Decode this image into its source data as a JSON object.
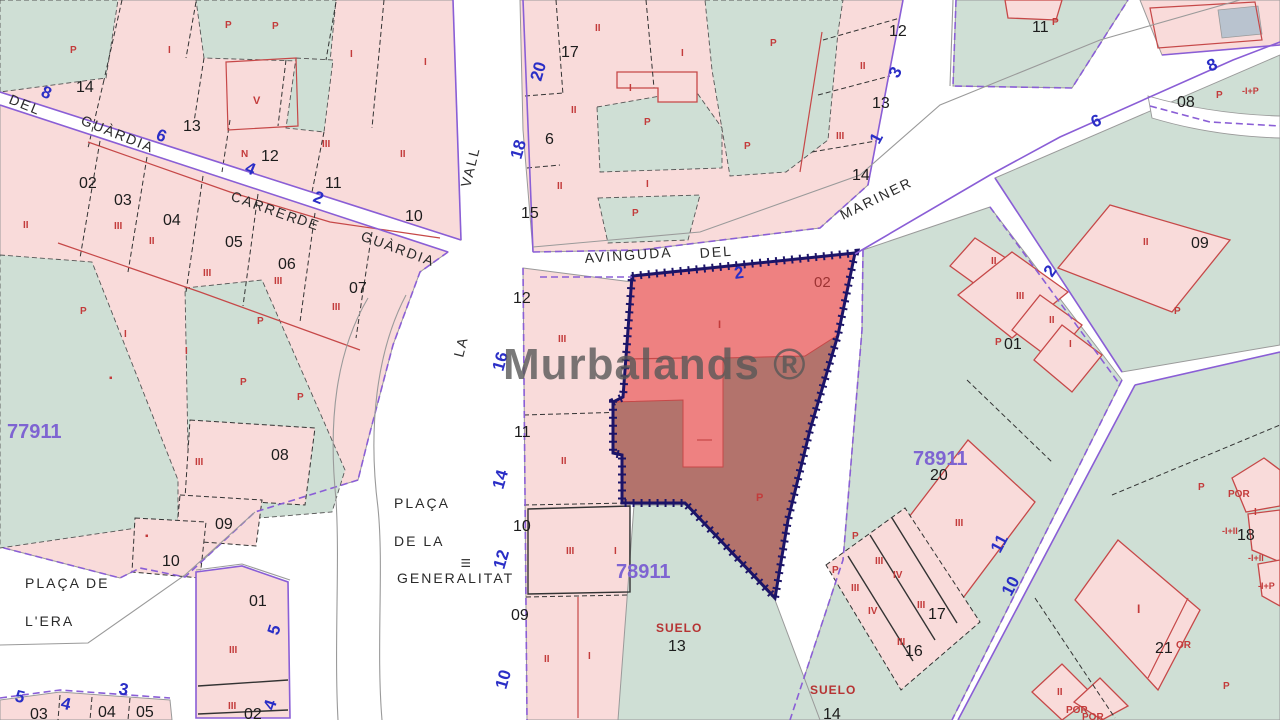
{
  "map": {
    "watermark": "Murbalands ®",
    "colors": {
      "parcel_pink": "#f9dbda",
      "parcel_green": "#cfdfd5",
      "highlight_light": "#ee8181",
      "highlight_dark": "#b3736c",
      "highlight_border": "#1c1468",
      "cadastral_purple": "#8a5ed6",
      "street_number_blue": "#2a2ec6",
      "construction_red": "#c33b3b",
      "zone_purple": "#7e64d2"
    },
    "street_names": [
      {
        "t": "DEL",
        "x": 8,
        "y": 103,
        "r": 22
      },
      {
        "t": "GUÀRDIA",
        "x": 80,
        "y": 124,
        "r": 22
      },
      {
        "t": "CARRER",
        "x": 230,
        "y": 200,
        "r": 20
      },
      {
        "t": "DE",
        "x": 296,
        "y": 223,
        "r": 20
      },
      {
        "t": "GUÀRDIA",
        "x": 360,
        "y": 240,
        "r": 20
      },
      {
        "t": "VALL",
        "x": 470,
        "y": 188,
        "r": -76
      },
      {
        "t": "LA",
        "x": 463,
        "y": 358,
        "r": -76
      },
      {
        "t": "AVINGUDA",
        "x": 585,
        "y": 263,
        "r": -4
      },
      {
        "t": "DEL",
        "x": 700,
        "y": 258,
        "r": -4
      },
      {
        "t": "MARINER",
        "x": 843,
        "y": 220,
        "r": -26
      },
      {
        "t": "PLAÇA",
        "x": 394,
        "y": 508
      },
      {
        "t": "DE LA",
        "x": 394,
        "y": 546
      },
      {
        "t": "GENERALITAT",
        "x": 397,
        "y": 583
      },
      {
        "t": "PLAÇA DE",
        "x": 25,
        "y": 588
      },
      {
        "t": "L'ERA",
        "x": 25,
        "y": 626
      }
    ],
    "parcel_numbers": [
      {
        "t": "14",
        "x": 76,
        "y": 92
      },
      {
        "t": "13",
        "x": 183,
        "y": 131
      },
      {
        "t": "12",
        "x": 261,
        "y": 161
      },
      {
        "t": "11",
        "x": 325,
        "y": 188
      },
      {
        "t": "10",
        "x": 405,
        "y": 221
      },
      {
        "t": "02",
        "x": 79,
        "y": 188
      },
      {
        "t": "03",
        "x": 114,
        "y": 205
      },
      {
        "t": "04",
        "x": 163,
        "y": 225
      },
      {
        "t": "05",
        "x": 225,
        "y": 247
      },
      {
        "t": "06",
        "x": 278,
        "y": 269
      },
      {
        "t": "07",
        "x": 349,
        "y": 293
      },
      {
        "t": "08",
        "x": 271,
        "y": 460
      },
      {
        "t": "09",
        "x": 215,
        "y": 529
      },
      {
        "t": "10",
        "x": 162,
        "y": 566
      },
      {
        "t": "01",
        "x": 249,
        "y": 606
      },
      {
        "t": "02",
        "x": 244,
        "y": 719
      },
      {
        "t": "03",
        "x": 30,
        "y": 719
      },
      {
        "t": "04",
        "x": 98,
        "y": 717
      },
      {
        "t": "05",
        "x": 136,
        "y": 717
      },
      {
        "t": "12",
        "x": 513,
        "y": 303
      },
      {
        "t": "11",
        "x": 514,
        "y": 437
      },
      {
        "t": "10",
        "x": 513,
        "y": 531
      },
      {
        "t": "09",
        "x": 511,
        "y": 620
      },
      {
        "t": "17",
        "x": 561,
        "y": 57
      },
      {
        "t": "6",
        "x": 545,
        "y": 144
      },
      {
        "t": "15",
        "x": 521,
        "y": 218
      },
      {
        "t": "12",
        "x": 889,
        "y": 36
      },
      {
        "t": "13",
        "x": 872,
        "y": 108
      },
      {
        "t": "14",
        "x": 852,
        "y": 180
      },
      {
        "t": "11",
        "x": 1032,
        "y": 32
      },
      {
        "t": "08",
        "x": 1177,
        "y": 107
      },
      {
        "t": "09",
        "x": 1191,
        "y": 248
      },
      {
        "t": "01",
        "x": 1004,
        "y": 349
      },
      {
        "t": "20",
        "x": 930,
        "y": 480
      },
      {
        "t": "17",
        "x": 928,
        "y": 619
      },
      {
        "t": "16",
        "x": 905,
        "y": 656
      },
      {
        "t": "18",
        "x": 1237,
        "y": 540
      },
      {
        "t": "21",
        "x": 1155,
        "y": 653
      },
      {
        "t": "13",
        "x": 668,
        "y": 651
      },
      {
        "t": "14",
        "x": 823,
        "y": 719
      },
      {
        "t": "02",
        "x": 814,
        "y": 287,
        "c": "#9c3333",
        "s": 15
      },
      {
        "t": "III",
        "x": 470,
        "y": 568,
        "r": -90,
        "s": 12
      }
    ],
    "street_numbers": [
      {
        "t": "8",
        "x": 40,
        "y": 96,
        "r": 22
      },
      {
        "t": "6",
        "x": 155,
        "y": 139,
        "r": 22
      },
      {
        "t": "4",
        "x": 244,
        "y": 172,
        "r": 22
      },
      {
        "t": "2",
        "x": 312,
        "y": 201,
        "r": 22
      },
      {
        "t": "20",
        "x": 541,
        "y": 82,
        "r": -74
      },
      {
        "t": "18",
        "x": 521,
        "y": 160,
        "r": -74
      },
      {
        "t": "16",
        "x": 503,
        "y": 372,
        "r": -74
      },
      {
        "t": "14",
        "x": 503,
        "y": 490,
        "r": -74
      },
      {
        "t": "12",
        "x": 504,
        "y": 570,
        "r": -74
      },
      {
        "t": "10",
        "x": 506,
        "y": 690,
        "r": -74
      },
      {
        "t": "2",
        "x": 735,
        "y": 279,
        "r": -8
      },
      {
        "t": "3",
        "x": 898,
        "y": 79,
        "r": -62
      },
      {
        "t": "1",
        "x": 879,
        "y": 145,
        "r": -62
      },
      {
        "t": "6",
        "x": 1094,
        "y": 128,
        "r": -24
      },
      {
        "t": "8",
        "x": 1210,
        "y": 72,
        "r": -24
      },
      {
        "t": "2",
        "x": 1052,
        "y": 278,
        "r": -55
      },
      {
        "t": "11",
        "x": 1000,
        "y": 554,
        "r": -62
      },
      {
        "t": "10",
        "x": 1011,
        "y": 597,
        "r": -62
      },
      {
        "t": "5",
        "x": 278,
        "y": 636,
        "r": -72
      },
      {
        "t": "4",
        "x": 274,
        "y": 711,
        "r": -72
      },
      {
        "t": "5",
        "x": 14,
        "y": 701,
        "r": 14
      },
      {
        "t": "4",
        "x": 60,
        "y": 708,
        "r": 14
      },
      {
        "t": "3",
        "x": 118,
        "y": 694,
        "r": 10
      }
    ],
    "zone_numbers": [
      {
        "t": "77911",
        "x": 7,
        "y": 438
      },
      {
        "t": "78911",
        "x": 616,
        "y": 578
      },
      {
        "t": "78911",
        "x": 913,
        "y": 465
      }
    ],
    "construction_labels": [
      {
        "t": "P",
        "x": 70,
        "y": 53
      },
      {
        "t": "I",
        "x": 168,
        "y": 53
      },
      {
        "t": "P",
        "x": 225,
        "y": 28
      },
      {
        "t": "P",
        "x": 272,
        "y": 29
      },
      {
        "t": "V",
        "x": 253,
        "y": 104,
        "s": 11
      },
      {
        "t": "I",
        "x": 350,
        "y": 57
      },
      {
        "t": "I",
        "x": 424,
        "y": 65
      },
      {
        "t": "III",
        "x": 322,
        "y": 147
      },
      {
        "t": "II",
        "x": 400,
        "y": 157
      },
      {
        "t": "N",
        "x": 241,
        "y": 157
      },
      {
        "t": "II",
        "x": 23,
        "y": 228
      },
      {
        "t": "III",
        "x": 114,
        "y": 229
      },
      {
        "t": "II",
        "x": 149,
        "y": 244
      },
      {
        "t": "III",
        "x": 203,
        "y": 276
      },
      {
        "t": "III",
        "x": 274,
        "y": 284
      },
      {
        "t": "III",
        "x": 332,
        "y": 310
      },
      {
        "t": "P",
        "x": 80,
        "y": 314
      },
      {
        "t": "P",
        "x": 257,
        "y": 324
      },
      {
        "t": "I",
        "x": 124,
        "y": 337
      },
      {
        "t": "I",
        "x": 185,
        "y": 354
      },
      {
        "t": "P",
        "x": 240,
        "y": 385
      },
      {
        "t": "P",
        "x": 297,
        "y": 400
      },
      {
        "t": "▪",
        "x": 109,
        "y": 381
      },
      {
        "t": "III",
        "x": 195,
        "y": 465
      },
      {
        "t": "▪",
        "x": 145,
        "y": 539
      },
      {
        "t": "III",
        "x": 229,
        "y": 653
      },
      {
        "t": "III",
        "x": 228,
        "y": 709
      },
      {
        "t": "III",
        "x": 558,
        "y": 342
      },
      {
        "t": "II",
        "x": 561,
        "y": 464
      },
      {
        "t": "III",
        "x": 566,
        "y": 554
      },
      {
        "t": "I",
        "x": 614,
        "y": 554
      },
      {
        "t": "II",
        "x": 544,
        "y": 662
      },
      {
        "t": "I",
        "x": 588,
        "y": 659
      },
      {
        "t": "I",
        "x": 718,
        "y": 328,
        "s": 11
      },
      {
        "t": "P",
        "x": 756,
        "y": 501,
        "s": 11
      },
      {
        "t": "II",
        "x": 595,
        "y": 31
      },
      {
        "t": "I",
        "x": 681,
        "y": 56
      },
      {
        "t": "P",
        "x": 770,
        "y": 46
      },
      {
        "t": "II",
        "x": 860,
        "y": 69
      },
      {
        "t": "II",
        "x": 571,
        "y": 113
      },
      {
        "t": "I",
        "x": 629,
        "y": 91
      },
      {
        "t": "P",
        "x": 644,
        "y": 125
      },
      {
        "t": "P",
        "x": 744,
        "y": 149
      },
      {
        "t": "II",
        "x": 557,
        "y": 189
      },
      {
        "t": "I",
        "x": 646,
        "y": 187
      },
      {
        "t": "P",
        "x": 632,
        "y": 216
      },
      {
        "t": "III",
        "x": 836,
        "y": 139
      },
      {
        "t": "P",
        "x": 1052,
        "y": 25
      },
      {
        "t": "P",
        "x": 1216,
        "y": 98
      },
      {
        "t": "-I+P",
        "x": 1242,
        "y": 94,
        "s": 9
      },
      {
        "t": "II",
        "x": 1143,
        "y": 245
      },
      {
        "t": "P",
        "x": 1174,
        "y": 314
      },
      {
        "t": "II",
        "x": 991,
        "y": 264
      },
      {
        "t": "III",
        "x": 1016,
        "y": 299
      },
      {
        "t": "II",
        "x": 1049,
        "y": 323
      },
      {
        "t": "I",
        "x": 1069,
        "y": 347
      },
      {
        "t": "P",
        "x": 995,
        "y": 345
      },
      {
        "t": "III",
        "x": 955,
        "y": 526
      },
      {
        "t": "P",
        "x": 852,
        "y": 539
      },
      {
        "t": "P",
        "x": 832,
        "y": 573
      },
      {
        "t": "III",
        "x": 875,
        "y": 564
      },
      {
        "t": "IV",
        "x": 893,
        "y": 578
      },
      {
        "t": "III",
        "x": 851,
        "y": 591
      },
      {
        "t": "IV",
        "x": 868,
        "y": 614
      },
      {
        "t": "III",
        "x": 917,
        "y": 608
      },
      {
        "t": "III",
        "x": 897,
        "y": 645
      },
      {
        "t": "P",
        "x": 1198,
        "y": 490
      },
      {
        "t": "POR",
        "x": 1228,
        "y": 497
      },
      {
        "t": "I",
        "x": 1254,
        "y": 515
      },
      {
        "t": "-I+II",
        "x": 1222,
        "y": 534,
        "s": 9
      },
      {
        "t": "-I+II",
        "x": 1248,
        "y": 561,
        "s": 9
      },
      {
        "t": "-I+P",
        "x": 1258,
        "y": 589,
        "s": 9
      },
      {
        "t": "I",
        "x": 1137,
        "y": 613,
        "s": 12
      },
      {
        "t": "OR",
        "x": 1176,
        "y": 648
      },
      {
        "t": "P",
        "x": 1223,
        "y": 689
      },
      {
        "t": "II",
        "x": 1057,
        "y": 695
      },
      {
        "t": "POR",
        "x": 1066,
        "y": 713
      },
      {
        "t": "POR",
        "x": 1082,
        "y": 720
      }
    ],
    "suelo_labels": [
      {
        "t": "SUELO",
        "x": 656,
        "y": 632
      },
      {
        "t": "SUELO",
        "x": 810,
        "y": 694
      }
    ]
  }
}
